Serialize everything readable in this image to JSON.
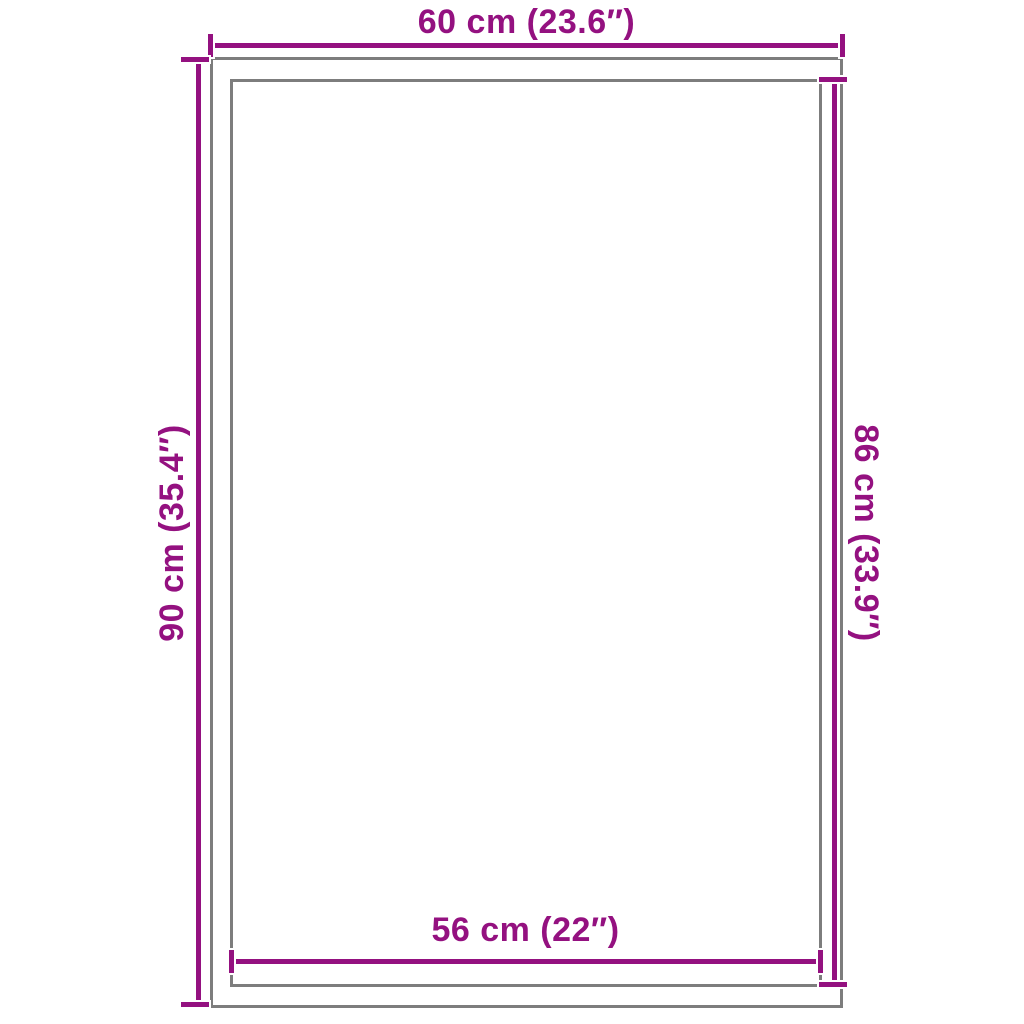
{
  "diagram": {
    "type": "product-dimension-diagram",
    "background_color": "#ffffff",
    "accent_color": "#941180",
    "outline_color": "#7d7d7d",
    "shapes": {
      "outer_rectangle": "product outer edge",
      "inner_rectangle": "product inner edge"
    },
    "dimensions": {
      "top": {
        "label": "60 cm (23.6″)",
        "measures": "outer width"
      },
      "left": {
        "label": "90 cm (35.4″)",
        "measures": "outer height"
      },
      "right": {
        "label": "86 cm (33.9″)",
        "measures": "inner height"
      },
      "bottom": {
        "label": "56 cm (22″)",
        "measures": "inner width"
      }
    }
  }
}
